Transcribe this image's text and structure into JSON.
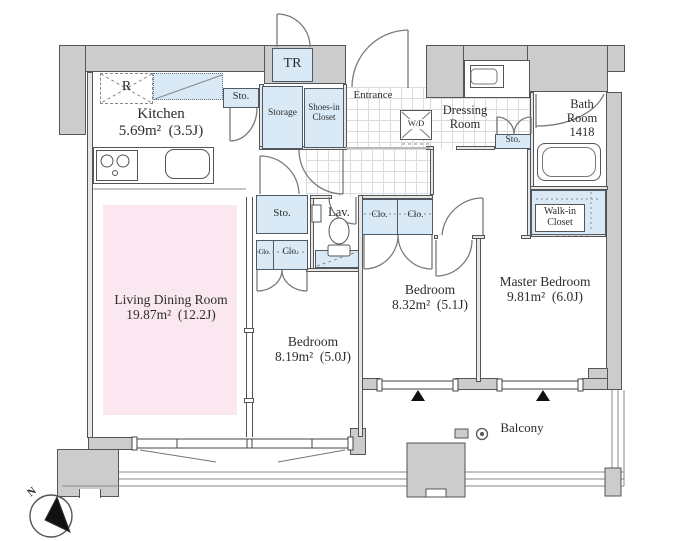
{
  "colors": {
    "wall_fill": "#cccccc",
    "wall_line": "#555555",
    "closet_fill": "#d9eaf6",
    "living_fill": "#fbe7f0",
    "tile_line": "#d9dde1",
    "marker_black": "#111111"
  },
  "rooms": {
    "kitchen": {
      "name": "Kitchen",
      "area": "5.69m² (3.5J)"
    },
    "living_dining": {
      "name": "Living Dining Room",
      "area": "19.87m² (12.2J)"
    },
    "bedroom_a": {
      "name": "Bedroom",
      "area": "8.19m² (5.0J)"
    },
    "bedroom_b": {
      "name": "Bedroom",
      "area": "8.32m² (5.1J)"
    },
    "master_bedroom": {
      "name": "Master Bedroom",
      "area": "9.81m² (6.0J)"
    },
    "bath": {
      "line1": "Bath",
      "line2": "Room",
      "line3": "1418"
    },
    "dressing": {
      "line1": "Dressing",
      "line2": "Room"
    },
    "entrance": {
      "name": "Entrance"
    },
    "lavatory": {
      "name": "Lav."
    },
    "balcony": {
      "name": "Balcony"
    }
  },
  "closets": {
    "trunk_room": "TR",
    "refrigerator": "R",
    "storage": "Storage",
    "shoes_closet": {
      "line1": "Shoes-in",
      "line2": "Closet"
    },
    "sto_kitchen": "Sto.",
    "sto_dressing": "Sto.",
    "sto_hall": "Sto.",
    "washer_dryer": "W/D",
    "walk_in_closet": {
      "line1": "Walk-in",
      "line2": "Closet"
    },
    "clo_hall_small": "Clo.",
    "clo_hall": "Clo.",
    "clo_bedroom_left": "Clo.",
    "clo_bedroom_right": "Clo."
  },
  "compass": {
    "north": "N"
  }
}
